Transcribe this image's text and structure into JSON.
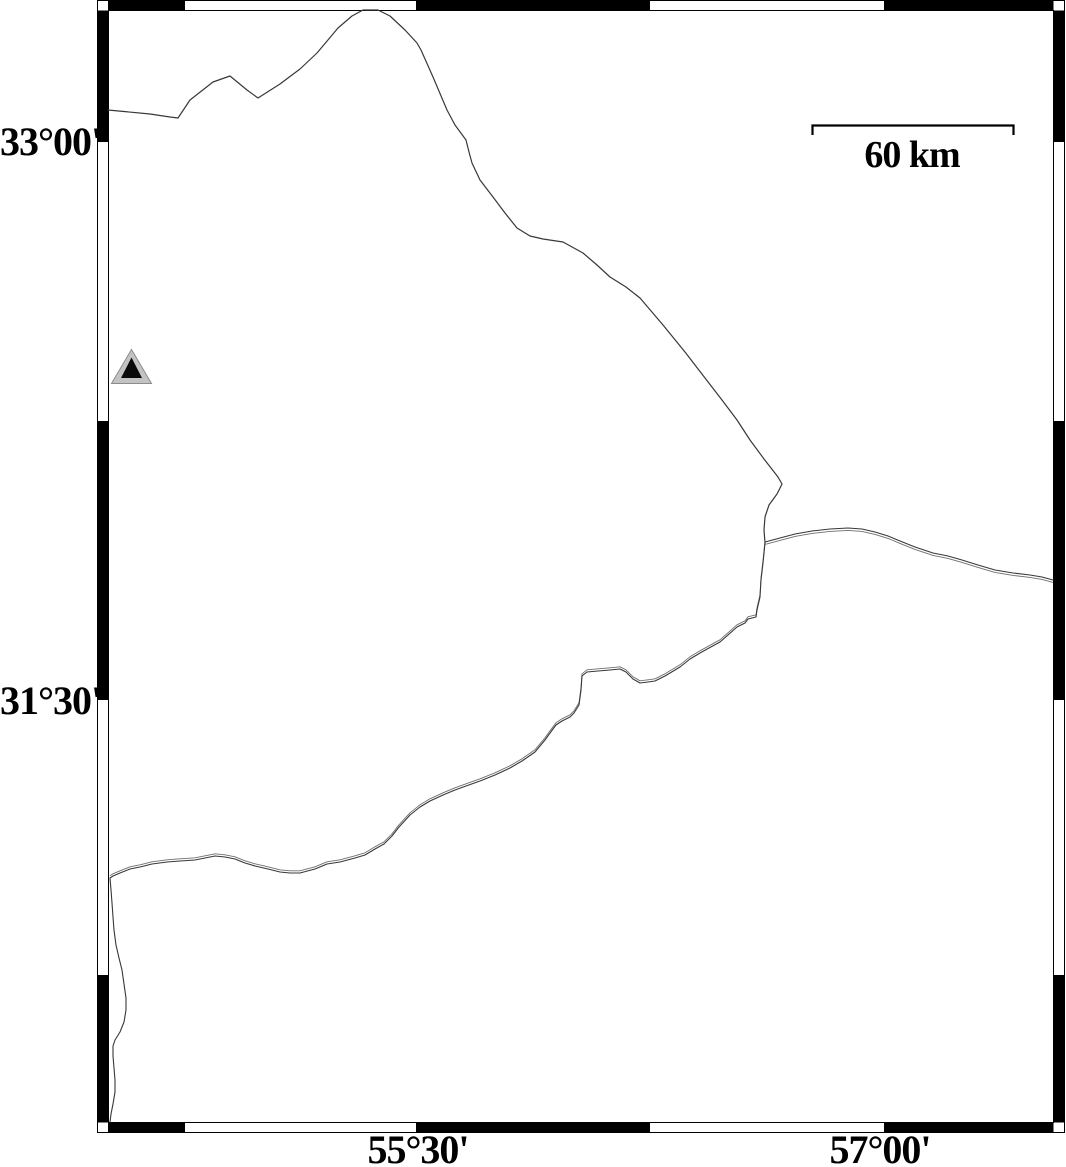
{
  "map": {
    "axis_labels": {
      "lat": [
        "33°00'",
        "31°30'"
      ],
      "lon": [
        "55°30'",
        "57°00'"
      ]
    },
    "scale_bar": {
      "label": "60 km"
    },
    "marker": {
      "type": "triangle",
      "outer_color": "#c3c3c3",
      "inner_color": "#0a0a0a"
    },
    "colors": {
      "background": "#ffffff",
      "frame": "#000000",
      "line": "#383838",
      "line_echo": "#6f6f6f"
    }
  }
}
